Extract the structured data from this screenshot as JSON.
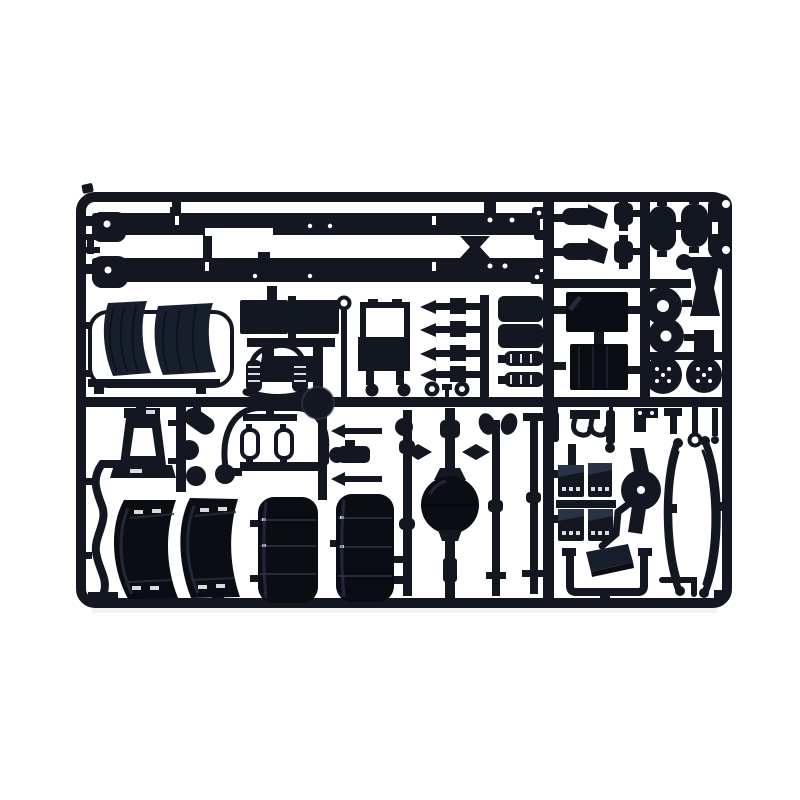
{
  "scene": {
    "type": "product-photograph",
    "subject": "Injection-molded plastic model kit sprue (parts tree) for a truck chassis kit",
    "background": "plain white seamless",
    "material": "dark blue-black styrene plastic",
    "frame_shape": "rounded rectangle sprue frame with internal runner grid"
  },
  "colors": {
    "background": "#ffffff",
    "plastic": "#131722",
    "plastic_dark": "#0a0d13",
    "plastic_soft": "#181f2c",
    "plastic_highlight": "#2a3346",
    "shadow": "#e9e9e9"
  },
  "sprue": {
    "rows": 4,
    "parts": [
      {
        "id": "chassis-rail-a",
        "label": "Chassis side rail (upper)",
        "qty": 1
      },
      {
        "id": "chassis-rail-b",
        "label": "Chassis side rail (lower)",
        "qty": 1
      },
      {
        "id": "rail-bowtie",
        "label": "Bow-tie rail coupling",
        "qty": 1
      },
      {
        "id": "frame-clips",
        "label": "Small frame clips",
        "qty": 2
      },
      {
        "id": "exhaust-elbow",
        "label": "Exhaust elbow with flange",
        "qty": 2
      },
      {
        "id": "small-canister",
        "label": "Small canister",
        "qty": 2
      },
      {
        "id": "air-tank",
        "label": "Air reservoir tank",
        "qty": 2
      },
      {
        "id": "open-end-bracket",
        "label": "Open-end flat bracket",
        "qty": 1
      },
      {
        "id": "dumbbell-link",
        "label": "Dumbbell link",
        "qty": 1
      },
      {
        "id": "front-mudguard",
        "label": "Front mudguard with wire frame",
        "qty": 2
      },
      {
        "id": "battery-cover",
        "label": "Battery cover panel",
        "qty": 2
      },
      {
        "id": "engine-cradle",
        "label": "Engine cradle with coil springs",
        "qty": 1
      },
      {
        "id": "radiator",
        "label": "Radiator frame",
        "qty": 1
      },
      {
        "id": "torque-rod",
        "label": "Torque rod",
        "qty": 4
      },
      {
        "id": "rings-and-balls",
        "label": "Pulley rings and ball fittings",
        "qty": 4
      },
      {
        "id": "equipment-panel",
        "label": "Equipment panel",
        "qty": 2
      },
      {
        "id": "silencer-half",
        "label": "Silencer half",
        "qty": 2
      },
      {
        "id": "battery-box",
        "label": "Battery box",
        "qty": 2
      },
      {
        "id": "brake-drum",
        "label": "Brake drum disc",
        "qty": 2
      },
      {
        "id": "wheel-hub",
        "label": "Wheel hub with bolt pattern",
        "qty": 2
      },
      {
        "id": "hourglass-bracket",
        "label": "Hourglass bracket",
        "qty": 1
      },
      {
        "id": "cover-plate",
        "label": "Small cover plate",
        "qty": 1
      },
      {
        "id": "support-trestle",
        "label": "Support trestle",
        "qty": 1
      },
      {
        "id": "oil-canister",
        "label": "Tilted oil canister",
        "qty": 1
      },
      {
        "id": "sphere-fitting",
        "label": "Sphere fitting",
        "qty": 3
      },
      {
        "id": "airline-arch",
        "label": "Air-line arch with twin reservoirs",
        "qty": 1
      },
      {
        "id": "idler-sphere",
        "label": "Idler sphere on runner",
        "qty": 1
      },
      {
        "id": "compressor",
        "label": "Compressor body",
        "qty": 1
      },
      {
        "id": "short-rod",
        "label": "Short torque rod",
        "qty": 2
      },
      {
        "id": "drive-shaft",
        "label": "Drive shaft",
        "qty": 1
      },
      {
        "id": "rear-axle",
        "label": "Rear axle with spherical differential",
        "qty": 1
      },
      {
        "id": "tie-rod",
        "label": "Tie rod",
        "qty": 2
      },
      {
        "id": "shock-absorber",
        "label": "Shock absorber",
        "qty": 2
      },
      {
        "id": "tow-hook-yoke",
        "label": "Tow-hook yoke",
        "qty": 1
      },
      {
        "id": "z-bracket",
        "label": "Z-bracket",
        "qty": 1
      },
      {
        "id": "t-bracket",
        "label": "T-bracket",
        "qty": 1
      },
      {
        "id": "hooked-rod",
        "label": "Hooked rod",
        "qty": 2
      },
      {
        "id": "s-bracket",
        "label": "S-shaped exhaust bracket",
        "qty": 1
      },
      {
        "id": "rear-mudguard",
        "label": "Rear mudguard",
        "qty": 2
      },
      {
        "id": "fuel-tank",
        "label": "Cylindrical fuel tank",
        "qty": 2
      },
      {
        "id": "cab-step",
        "label": "Cab entry step",
        "qty": 4
      },
      {
        "id": "step-hanger",
        "label": "Hanging step plate",
        "qty": 1
      },
      {
        "id": "diagonal-bracket",
        "label": "Diagonal bracket",
        "qty": 1
      },
      {
        "id": "differential-carrier",
        "label": "Differential carrier",
        "qty": 1
      },
      {
        "id": "leaf-spring",
        "label": "Leaf spring",
        "qty": 2
      },
      {
        "id": "u-pipe",
        "label": "U-shaped pipe",
        "qty": 1
      },
      {
        "id": "corner-bracket",
        "label": "Corner bracket",
        "qty": 1
      }
    ]
  }
}
